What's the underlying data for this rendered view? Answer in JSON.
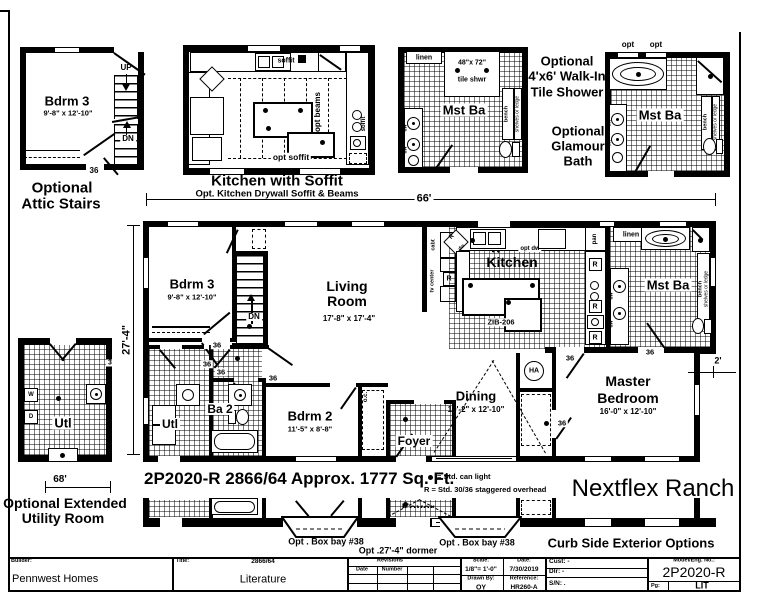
{
  "insets": {
    "attic": {
      "room": "Bdrm 3",
      "size": "9'-8\" x 12'-10\"",
      "up": "UP",
      "dn": "DN",
      "door": "36",
      "cap1": "Optional",
      "cap2": "Attic Stairs"
    },
    "soffit": {
      "soffit": "soffit",
      "beams": "opt beams",
      "opt_soffit": "opt soffit",
      "title": "Kitchen with Soffit",
      "sub": "Opt. Kitchen Drywall Soffit & Beams"
    },
    "shower": {
      "linen": "linen",
      "size": "48\"x 72\"",
      "shwr": "tile shwr",
      "room": "Mst Ba",
      "bench": "bench",
      "shelves": "shelves or ledge",
      "dw": "dw",
      "cap1": "Optional",
      "cap2": "4'x6' Walk-In",
      "cap3": "Tile Shower"
    },
    "glamour": {
      "opt": "opt",
      "room": "Mst Ba",
      "bench": "bench",
      "shelves": "shelves or ledge",
      "dw": "dw",
      "cap1": "Optional",
      "cap2": "Glamour",
      "cap3": "Bath"
    },
    "utility": {
      "room": "Utl",
      "w": "W",
      "d": "D",
      "num": "3",
      "dim": "68'",
      "cap1": "Optional Extended",
      "cap2": "Utility Room"
    }
  },
  "plan": {
    "dim_top": "66'",
    "dim_left": "27'-4\"",
    "dim_right": "2'",
    "door": "36",
    "ha": "HA",
    "bdrm3": {
      "name": "Bdrm 3",
      "size": "9'-8\" x 12'-10\""
    },
    "living": {
      "line1": "Living",
      "line2": "Room",
      "size": "17'-8\" x 17'-4\""
    },
    "kitchen": {
      "name": "Kitchen",
      "optdw": "opt dw",
      "zib": "ZIB-206",
      "pan": "pan",
      "r": "R",
      "dw": "dw",
      "cab": "cabt",
      "tv": "tv center"
    },
    "mstba": {
      "name": "Mst Ba",
      "linen": "linen",
      "bench": "bench",
      "shelves": "shelves or ledge",
      "dw": "dw"
    },
    "dining": {
      "name": "Dining",
      "size": "10'-2\" x 12'-10\""
    },
    "master": {
      "line1": "Master",
      "line2": "Bedroom",
      "size": "16'-0\" x 12'-10\""
    },
    "bdrm2": {
      "name": "Bdrm 2",
      "size": "11'-5\" x 8'-8\"",
      "oc": "o.c."
    },
    "ba2": {
      "name": "Ba 2"
    },
    "utl": {
      "name": "Utl"
    },
    "foyer": {
      "name": "Foyer"
    },
    "stairs": {
      "dn": "DN"
    }
  },
  "footer": {
    "spec": "2P2020-R 2866/64  Approx. 1777 Sq. Ft.",
    "legend_dot": "= Std. can light",
    "legend_r": "R = Std. 30/36 staggered overhead",
    "brand": "Nextflex Ranch"
  },
  "curb": {
    "bay1": "Opt . Box bay #38",
    "dormer": "Opt .27'-4\" dormer",
    "bay2": "Opt . Box bay #38",
    "caption": "Curb Side Exterior Options"
  },
  "titleblock": {
    "builder_label": "Builder:",
    "builder": "Pennwest Homes",
    "title_label": "Title:",
    "title_num": "2866/64",
    "title_name": "Literature",
    "revisions": "Revisions",
    "date_col": "Date",
    "number_col": "Number",
    "scale_label": "Scale:",
    "scale": "1/8\"= 1'-0\"",
    "date_label": "Date:",
    "date": "7/30/2019",
    "drawn_label": "Drawn By:",
    "drawn": "OY",
    "ref_label": "Reference:",
    "ref": "HR260-A",
    "cust": "Cust: -",
    "dlr": "Dlr: -",
    "sn": "S/N: .",
    "model_label": "Model/Eng. No.:",
    "model": "2P2020-R",
    "pg_label": "Pg:",
    "pg": "LIT"
  }
}
